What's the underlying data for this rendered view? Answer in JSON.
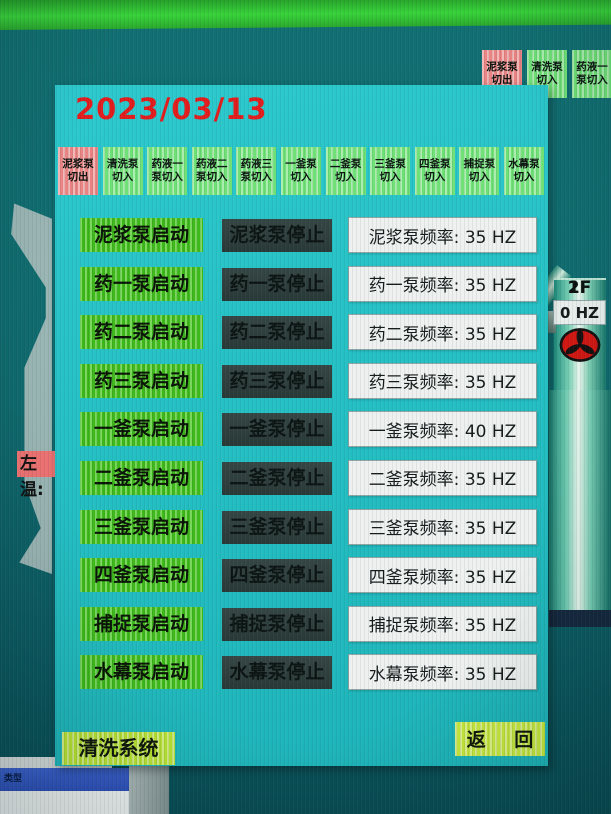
{
  "background": {
    "top_right_tabs": [
      {
        "label": "泥浆泵\n切出",
        "variant": "out"
      },
      {
        "label": "清洗泵\n切入",
        "variant": "in"
      },
      {
        "label": "药液一\n泵切入",
        "variant": "in"
      }
    ],
    "left_temp_label": "左温:",
    "dialog_title": "类型"
  },
  "panel": {
    "date": "2023/03/13",
    "tabs": [
      {
        "label": "泥浆泵\n切出",
        "variant": "out"
      },
      {
        "label": "清洗泵\n切入",
        "variant": "in"
      },
      {
        "label": "药液一\n泵切入",
        "variant": "in"
      },
      {
        "label": "药液二\n泵切入",
        "variant": "in"
      },
      {
        "label": "药液三\n泵切入",
        "variant": "in"
      },
      {
        "label": "一釜泵\n切入",
        "variant": "in"
      },
      {
        "label": "二釜泵\n切入",
        "variant": "in"
      },
      {
        "label": "三釜泵\n切入",
        "variant": "in"
      },
      {
        "label": "四釜泵\n切入",
        "variant": "in"
      },
      {
        "label": "捕捉泵\n切入",
        "variant": "in"
      },
      {
        "label": "水幕泵\n切入",
        "variant": "in"
      }
    ],
    "rows": [
      {
        "start": "泥浆泵启动",
        "stop": "泥浆泵停止",
        "freq": "泥浆泵频率: 35 HZ"
      },
      {
        "start": "药一泵启动",
        "stop": "药一泵停止",
        "freq": "药一泵频率: 35 HZ"
      },
      {
        "start": "药二泵启动",
        "stop": "药二泵停止",
        "freq": "药二泵频率: 35 HZ"
      },
      {
        "start": "药三泵启动",
        "stop": "药三泵停止",
        "freq": "药三泵频率: 35 HZ"
      },
      {
        "start": "一釜泵启动",
        "stop": "一釜泵停止",
        "freq": "一釜泵频率: 40 HZ"
      },
      {
        "start": "二釜泵启动",
        "stop": "二釜泵停止",
        "freq": "二釜泵频率: 35 HZ"
      },
      {
        "start": "三釜泵启动",
        "stop": "三釜泵停止",
        "freq": "三釜泵频率: 35 HZ"
      },
      {
        "start": "四釜泵启动",
        "stop": "四釜泵停止",
        "freq": "四釜泵频率: 35 HZ"
      },
      {
        "start": "捕捉泵启动",
        "stop": "捕捉泵停止",
        "freq": "捕捉泵频率: 35 HZ"
      },
      {
        "start": "水幕泵启动",
        "stop": "水幕泵停止",
        "freq": "水幕泵频率: 35 HZ"
      }
    ],
    "footer": {
      "system_label": "清洗系统",
      "back_button": "返 回"
    }
  },
  "pipe": {
    "fans": [
      {
        "floor": "1F",
        "freq": "0 HZ"
      },
      {
        "floor": "2F",
        "freq": "0 HZ"
      }
    ]
  },
  "colors": {
    "start_green": "#46c81e",
    "stop_dark": "#2e3e3c",
    "alarm_red": "#e31d1d",
    "panel_cyan": "#25c3c7",
    "fan_red": "#d21712"
  }
}
